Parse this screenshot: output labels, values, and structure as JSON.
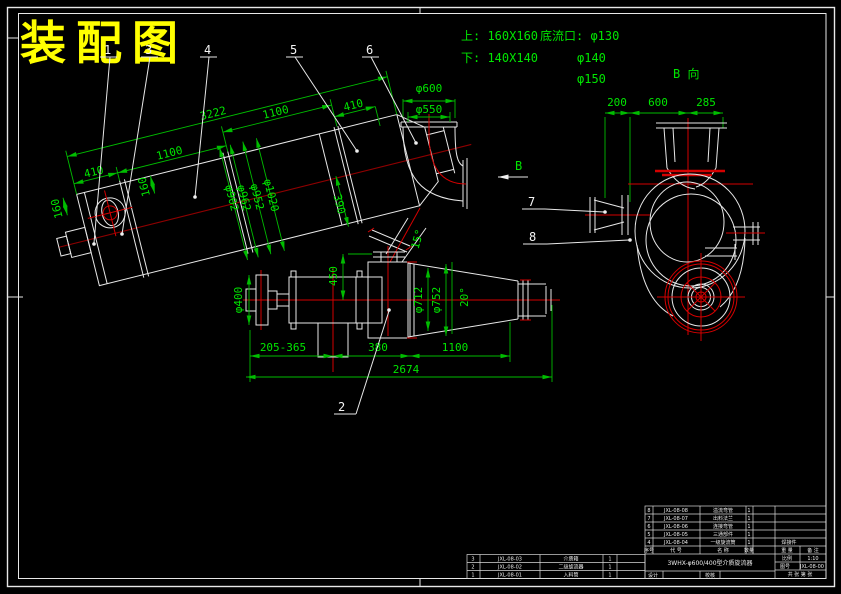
{
  "sheet": {
    "title": "装配图"
  },
  "notes": {
    "upper": "上: 160X160",
    "lower": "下: 140X140",
    "underflow_label": "底流口: φ130",
    "underflow_2": "φ140",
    "underflow_3": "φ150"
  },
  "view_b": {
    "name": "B 向",
    "arrow": "B",
    "dims": [
      "200",
      "600",
      "285"
    ]
  },
  "main_view": {
    "dims": {
      "overall": "3222",
      "seg1": "1100",
      "seg2": "1100",
      "left": "410",
      "left_h": "160",
      "feed": "160",
      "dia1": "φ902",
      "dia2": "φ962",
      "dia3": "φ952",
      "dia4": "φ1020",
      "right": "390",
      "top_right": "410",
      "angle": "15°",
      "elbow_od": "φ600",
      "elbow_id": "φ550"
    }
  },
  "cyclone_view": {
    "dims": {
      "shaft": "φ400",
      "height": "450",
      "range": "205-365",
      "mid": "380",
      "cone": "1100",
      "overall": "2674",
      "dia1": "φ712",
      "dia2": "φ752",
      "angle": "20°"
    }
  },
  "part_labels": {
    "p1": "1",
    "p2": "2",
    "p3": "3",
    "p4": "4",
    "p5": "5",
    "p6": "6",
    "p7": "7",
    "p8": "8"
  },
  "title_block": {
    "bom_upper": [
      {
        "no": "8",
        "code": "JXL-08-08",
        "name": "溢流弯管",
        "qty": "1",
        "mat": ""
      },
      {
        "no": "7",
        "code": "JXL-08-07",
        "name": "出料法兰",
        "qty": "1",
        "mat": ""
      },
      {
        "no": "6",
        "code": "JXL-08-06",
        "name": "连接弯管",
        "qty": "1",
        "mat": ""
      },
      {
        "no": "5",
        "code": "JXL-08-05",
        "name": "三通部件",
        "qty": "1",
        "mat": ""
      },
      {
        "no": "4",
        "code": "JXL-08-04",
        "name": "一级旋流筒",
        "qty": "1",
        "mat": "焊接件"
      }
    ],
    "header": {
      "no": "序号",
      "code": "代  号",
      "name": "名  称",
      "qty": "数量",
      "weight": "重 量",
      "remark": "备 注"
    },
    "bom_lower": [
      {
        "no": "3",
        "code": "JXL-08-03",
        "name": "介质箱",
        "qty": "1"
      },
      {
        "no": "2",
        "code": "JXL-08-02",
        "name": "二级旋流器",
        "qty": "1"
      },
      {
        "no": "1",
        "code": "JXL-08-01",
        "name": "入料筒",
        "qty": "1"
      }
    ],
    "title": "3WHX-φ600/400型介质旋流器",
    "scale_label": "比例",
    "scale": "1:10",
    "dno_label": "图号",
    "drawing_no": "JXL-08-00",
    "sheet_info": "共 张 第 张",
    "design": "设计",
    "check": "校核"
  }
}
